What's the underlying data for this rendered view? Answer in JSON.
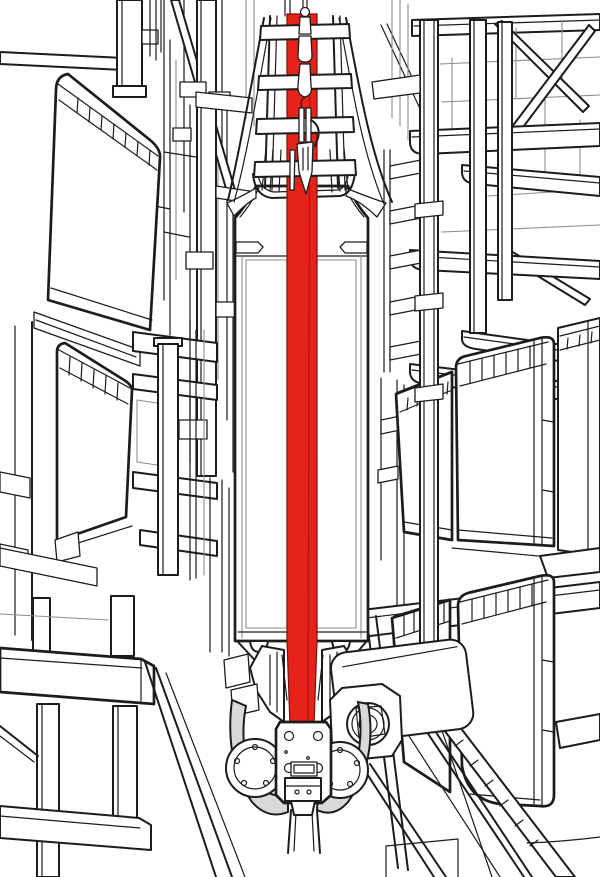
{
  "illustration": {
    "alt": "Black and white technical line drawing of an automated small-parts warehouse aisle: storage racks filled with totes on both sides and a stacker crane in the centre whose red vertical lift belt runs from a hook at the top down to a wheeled drive carriage on a floor rail.",
    "background": "#ffffff"
  },
  "colors": {
    "background": "#ffffff",
    "line": "#1c1c1c",
    "line_light": "#8c8c8c",
    "belt_red": "#e5231b",
    "belt_red_shadow": "#b5170f",
    "belt_outline": "#7f0f08",
    "shade_gray": "#d9d9d9"
  },
  "components": {
    "stacker_crane": {
      "mast_head": "ladder frame with rungs",
      "lift_belt": "red hoisting belt",
      "belt_tackle": "hook, chain links and belt clamp",
      "mast_column": "white mast column with inner panel",
      "drive_carriage": "bolted carriage plate with guide wheels and fenders",
      "travel_motor": "cylindrical travel drive motor",
      "floor_rail": "central floor guide rail"
    },
    "left_rack": {
      "upper_bin": "storage tote seen from the side",
      "lower_bin": "storage tote seen from the side",
      "frame": "uprights, cross beams, diagonal brace and base legs"
    },
    "right_rack": {
      "upper_frame": "posts, shelf beams and X bracing",
      "bins": [
        "rear tote",
        "front tote",
        "edge tote",
        "lower rear tote",
        "lower front tote",
        "bottom shelf tote rim"
      ],
      "shelf_rails": "receding shelf edge rails"
    }
  }
}
